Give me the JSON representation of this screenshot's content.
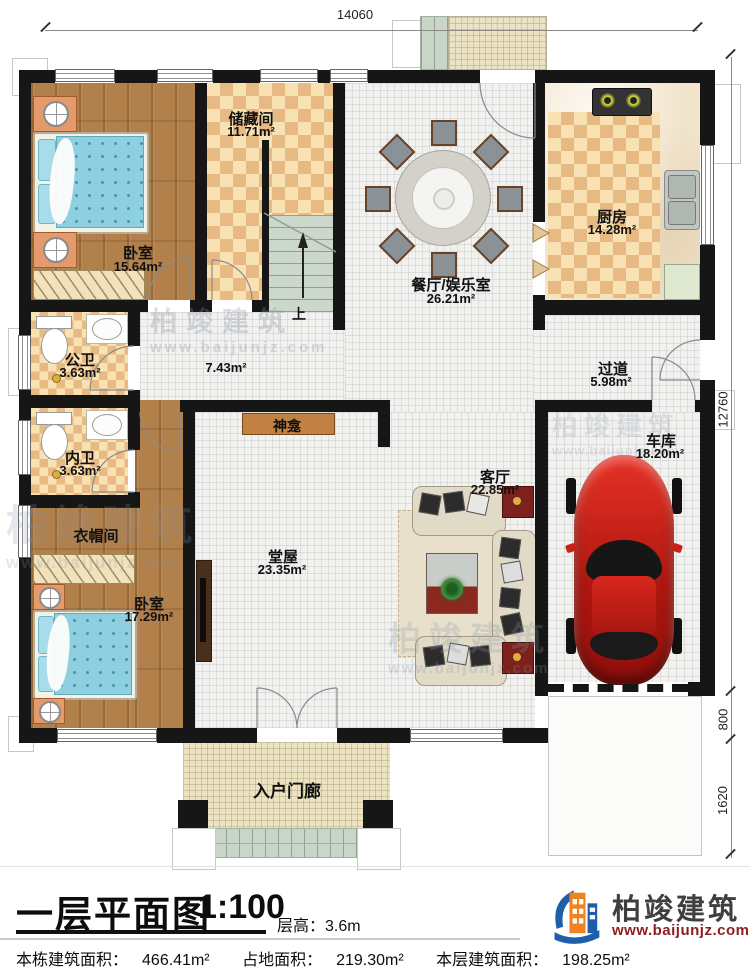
{
  "plan": {
    "rooms": {
      "bedroom_top": {
        "name": "卧室",
        "area": "15.64m²"
      },
      "storage": {
        "name": "储藏间",
        "area": "11.71m²"
      },
      "dining": {
        "name": "餐厅/娱乐室",
        "area": "26.21m²"
      },
      "kitchen": {
        "name": "厨房",
        "area": "14.28m²"
      },
      "bath_public": {
        "name": "公卫",
        "area": "3.63m²"
      },
      "bath_private": {
        "name": "内卫",
        "area": "3.63m²"
      },
      "hallway": {
        "area": "7.43m²"
      },
      "corridor": {
        "name": "过道",
        "area": "5.98m²"
      },
      "cloakroom": {
        "name": "衣帽间"
      },
      "main_hall": {
        "name": "堂屋",
        "area": "23.35m²"
      },
      "living": {
        "name": "客厅",
        "area": "22.85m²"
      },
      "garage": {
        "name": "车库",
        "area": "18.20m²"
      },
      "bedroom_bottom": {
        "name": "卧室",
        "area": "17.29m²"
      },
      "porch": {
        "name": "入户门廊"
      },
      "shrine": {
        "name": "神龛"
      },
      "stairs": {
        "up": "上"
      }
    },
    "dimensions": {
      "top": "14060",
      "side": "12760",
      "side_lower": "800",
      "side_bottom": "1620"
    }
  },
  "title_block": {
    "title": "一层平面图",
    "scale": "1:100",
    "floor_height_label": "层高：",
    "floor_height_value": "3.6m",
    "stats": [
      {
        "label": "本栋建筑面积：",
        "value": "466.41m²"
      },
      {
        "label": "占地面积：",
        "value": "219.30m²"
      },
      {
        "label": "本层建筑面积：",
        "value": "198.25m²"
      }
    ]
  },
  "brand": {
    "name": "柏竣建筑",
    "website": "www.baijunjz.com"
  },
  "watermark": {
    "name": "柏竣建筑",
    "website": "www.baijunjz.com"
  },
  "palette": {
    "wall": "#161616",
    "wood": "#b2804a",
    "checker_light": "#f8e2b4",
    "checker_dark": "#e7ba83",
    "tile": "#f1f1ef",
    "stair": "#ccd8cb",
    "bed": "#8ecfe0",
    "car_red": "#c9201a",
    "brand_blue": "#1d5fa8",
    "brand_orange": "#f08222",
    "brand_url_red": "#8b1f1f"
  }
}
